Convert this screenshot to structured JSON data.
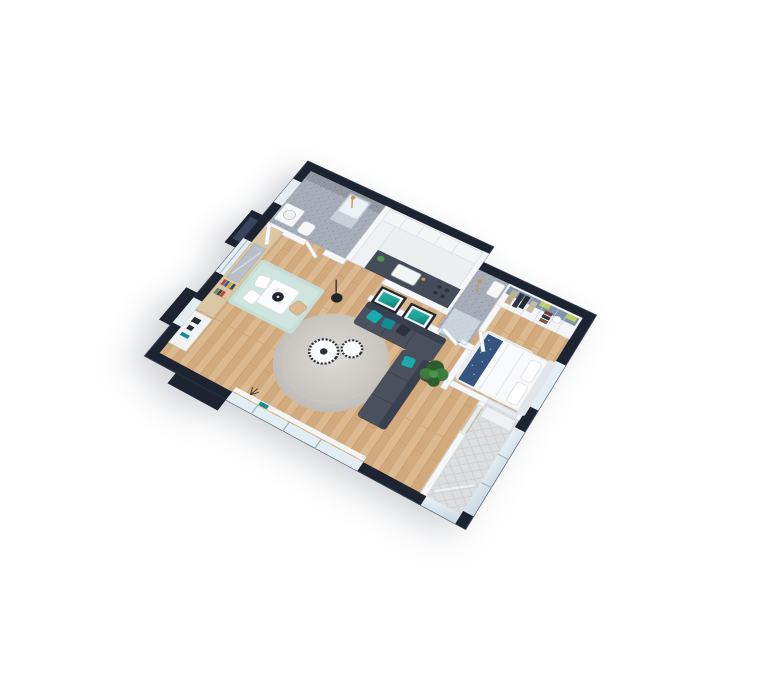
{
  "scene": {
    "title": "3D isometric floor plan render of a one-bedroom apartment",
    "background": "#ffffff",
    "view": "axonometric top-down, rotated ~31 degrees, tilted ~34 degrees"
  },
  "palette": {
    "outer_wall": "#1c2431",
    "outer_wall_hi": "#303a50",
    "porch_floor": "#3a455c",
    "wood_a": "#ddb990",
    "wood_b": "#d1aa7e",
    "wood_seam": "#bf9668",
    "tile_base": "#a8aeb9",
    "tile_dot": "#8b92a2",
    "tile_dot2": "#969dac",
    "wall_white": "#f6f7f9",
    "wall_edge": "#d0d4db",
    "glass": "#e3edf4",
    "glass_frame": "#9fb0bf",
    "counter": "#454c59",
    "cabinet": "#f3f5f7",
    "brass": "#c39b52",
    "sofa": "#4a505c",
    "sofa_dark": "#394050",
    "teal": "#17adb0",
    "teal_dark": "#0f8e93",
    "pillow_navy": "#2c3240",
    "art_frame": "#23272f",
    "art_mat": "#f1f3f5",
    "art_teal_light": "#2bb3a6",
    "art_teal": "#1da095",
    "art_teal_dark": "#11776f",
    "rug_light": "#dedbd7",
    "rug_mid": "#c9c6c2",
    "rug_edge": "#bcb9b5",
    "mint": "#c5dfd8",
    "mint_light": "#d8eae4",
    "table_white": "#fafbfd",
    "lamp_black": "#20252e",
    "plant": "#3a7d3d",
    "plant_dark": "#2c5e2f",
    "plant_light": "#4f9350",
    "pot": "#5f4632",
    "bed_white": "#f3f5f7",
    "duvet": "#f8f9fb",
    "bed_blue": "#35557f",
    "headboard": "#e2e6eb",
    "bed_rug": "#edeff1",
    "closet_back": "#7d95ad",
    "lime": "#bccf5e",
    "maroon": "#7e3a44",
    "garment_beige": "#bfae8d",
    "garment_dark": "#2e3644",
    "garment_brown": "#7a5a48",
    "wood_panel": "#dcc7a4",
    "mirror": "#b9bfc8",
    "balcony_tile": "#dbdfe0",
    "balcony_line": "#c8cdcf",
    "book_red": "#b8443c",
    "book_blue": "#31639c",
    "book_yellow": "#d8b04a",
    "book_green": "#6b8f5a",
    "book_dark": "#3a4653",
    "sill_white": "#f3f5f6"
  },
  "rooms": [
    {
      "name": "bathroom",
      "floor": "grey mosaic tile",
      "features": [
        "walk-in shower",
        "brass shower fixture",
        "vanity",
        "wc"
      ]
    },
    {
      "name": "kitchen",
      "floor": "light grey",
      "features": [
        "white cabinet run",
        "tall cabinet",
        "dark countertop",
        "sink with faucet",
        "hob"
      ]
    },
    {
      "name": "shower-room",
      "floor": "grey mosaic tile",
      "features": [
        "glass shower",
        "brass fixture",
        "washbasin"
      ]
    },
    {
      "name": "walk-in-closet",
      "features": [
        "open shelving",
        "hanging clothes",
        "lime storage boxes",
        "folded garment stacks",
        "hat box"
      ]
    },
    {
      "name": "bedroom",
      "floor": "light oak parquet",
      "features": [
        "double bed",
        "white duvet",
        "navy accent throw",
        "pillows",
        "white rug",
        "window"
      ]
    },
    {
      "name": "living-room",
      "floor": "light oak parquet",
      "features": [
        "corner sofa with teal cushions",
        "round grey rug",
        "two round coffee tables",
        "two teal wall artworks",
        "potted plant",
        "black floor lamp",
        "panoramic window"
      ]
    },
    {
      "name": "dining-area",
      "floor": "light oak parquet",
      "features": [
        "mint rug",
        "white table",
        "chairs",
        "black pendant lamp"
      ]
    },
    {
      "name": "entry-hall",
      "features": [
        "entry door",
        "wardrobe panel",
        "mirror",
        "bookshelf",
        "console with decor"
      ]
    },
    {
      "name": "balcony",
      "floor": "hexagonal tile",
      "features": [
        "glass railing",
        "glass sliding door",
        "white ledge"
      ]
    }
  ]
}
